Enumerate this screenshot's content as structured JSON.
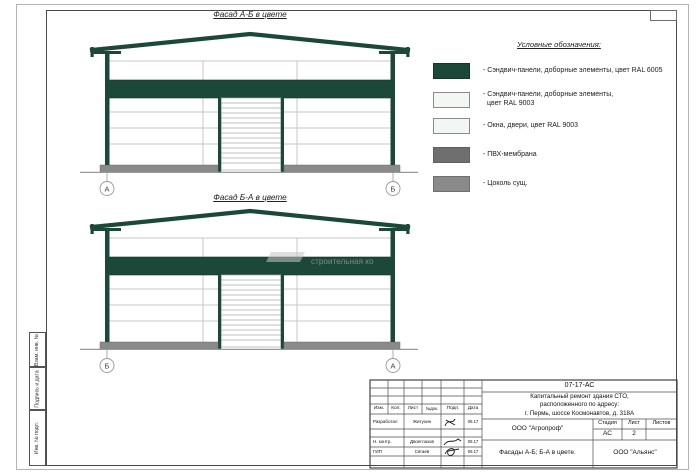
{
  "colors": {
    "ral6005_green": "#1c4839",
    "ral9003_white": "#f3f7f3",
    "window_white": "#f3f7f3",
    "pvc_membrane_gray": "#6f6f6f",
    "plinth_gray": "#8a8a8a"
  },
  "facades": {
    "top": {
      "title": "Фасад А-Б в цвете",
      "axis_left": "А",
      "axis_right": "Б"
    },
    "bottom": {
      "title": "Фасад Б-А в цвете",
      "axis_left": "Б",
      "axis_right": "А"
    }
  },
  "watermark": {
    "text": "строительная ко"
  },
  "legend": {
    "title": "Условные обозначения:",
    "items": [
      {
        "label": "- Сэндвич-панели, доборные элементы,  цвет RAL 6005",
        "color": "#1c4839"
      },
      {
        "label": "- Сэндвич-панели, доборные элементы,",
        "label2": "цвет RAL 9003",
        "color": "#f3f7f3"
      },
      {
        "label": "- Окна, двери, цвет RAL 9003",
        "color": "#f3f7f3"
      },
      {
        "label": "- ПВХ-мембрана",
        "color": "#6f6f6f"
      },
      {
        "label": "- Цоколь сущ.",
        "color": "#8a8a8a"
      }
    ]
  },
  "side_stamp": {
    "cells": [
      "Взам. инв. №",
      "Подпись и дата",
      "Инв. № подл."
    ]
  },
  "title_block": {
    "doc_code": "07-17-АС",
    "project_line1": "Капитальный ремонт здания СТО,",
    "project_line2": "расположенного по адресу:",
    "project_line3": "г. Пермь, шоссе Космонавтов, д. 318А",
    "org_design": "ООО \"Агропроф\"",
    "sheet_title": "Фасады А-Б; Б-А в цвете.",
    "org_contractor": "ООО \"Альянс\"",
    "rev_headers": [
      "Изм.",
      "Кол.",
      "Лист",
      "№док.",
      "Подп.",
      "Дата"
    ],
    "stage_header": "Стадия",
    "sheet_header": "Лист",
    "sheets_header": "Листов",
    "stage_value": "АС",
    "sheet_value": "2",
    "sheets_value": "",
    "signers": [
      {
        "role": "Разработал",
        "name": "Житухин",
        "date": "06.17"
      },
      {
        "role": "Н. контр.",
        "name": "Двоеглазов",
        "date": "06.17"
      },
      {
        "role": "ГИП",
        "name": "Сягаев",
        "date": "06.17"
      }
    ]
  }
}
